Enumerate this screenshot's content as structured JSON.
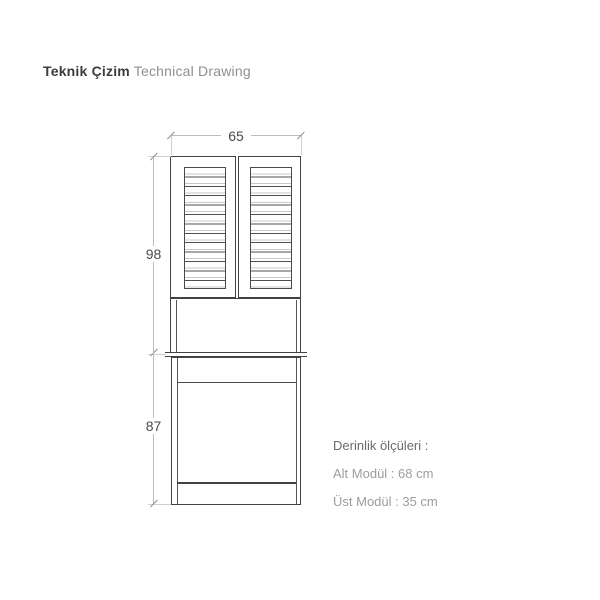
{
  "header": {
    "title_primary": "Teknik Çizim",
    "title_secondary": "Technical Drawing"
  },
  "drawing": {
    "width_label": "65",
    "upper_height_label": "98",
    "lower_height_label": "87"
  },
  "depth_info": {
    "heading": "Derinlik ölçüleri :",
    "alt_module": "Alt Modül : 68 cm",
    "ust_module": "Üst Modül : 35 cm"
  },
  "colors": {
    "outline": "#424242",
    "dimension_line": "#bdbdbd",
    "dimension_text": "#4a4a4a",
    "title_primary": "#3c3c3c",
    "title_secondary": "#8f8f8f",
    "depth_heading": "#6b6b6b",
    "depth_text": "#9d9d9d",
    "background": "#ffffff"
  }
}
